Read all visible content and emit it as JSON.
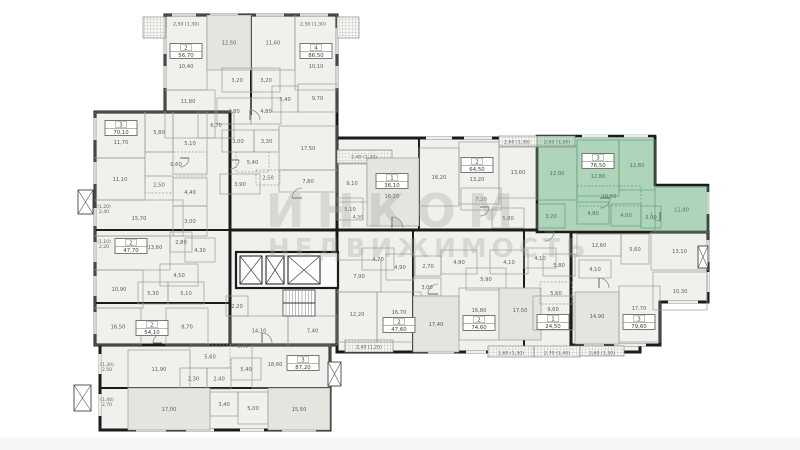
{
  "watermark": {
    "line1": "ИНКОМ",
    "line2": "НЕДВИЖИМОСТЬ"
  },
  "palette": {
    "wall": "#1b1b1b",
    "fill": "#f0f0ec",
    "fill2": "#e5e5df",
    "thin": "#9c9c96",
    "green": "#aed5ba",
    "greenLine": "#67997b",
    "greenText": "#4d7560",
    "text": "#5f5f5a",
    "badgeBorder": "#6b6b66"
  },
  "plan": {
    "sections": [
      {
        "r": [
          165,
          15,
          172,
          215
        ]
      },
      {
        "r": [
          95,
          112,
          135,
          233
        ]
      },
      {
        "r": [
          100,
          345,
          230,
          85
        ]
      },
      {
        "r": [
          230,
          230,
          107,
          115
        ]
      },
      {
        "r": [
          337,
          138,
          318,
          92
        ]
      },
      {
        "r": [
          337,
          230,
          303,
          122
        ]
      },
      {
        "p": "571,232 708,232 708,302 660,302 660,345 571,345"
      }
    ],
    "green_unit": {
      "points": "537,136 655,136 655,185 708,185 708,232 537,232"
    },
    "walls": [
      [
        251,
        15,
        251,
        115
      ],
      [
        419,
        138,
        419,
        230
      ],
      [
        413,
        230,
        413,
        352
      ],
      [
        524,
        230,
        524,
        352
      ],
      [
        571,
        232,
        571,
        345
      ],
      [
        95,
        230,
        230,
        230
      ],
      [
        95,
        303,
        230,
        303
      ],
      [
        100,
        388,
        330,
        388
      ],
      [
        230,
        140,
        230,
        345
      ]
    ],
    "rooms": [
      [
        165,
        15,
        42,
        75,
        "10,40",
        "",
        186,
        66
      ],
      [
        207,
        15,
        44,
        55,
        "12,50",
        "2"
      ],
      [
        251,
        15,
        44,
        55,
        "11,60",
        ""
      ],
      [
        295,
        15,
        42,
        75,
        "10,10",
        "",
        316,
        66
      ],
      [
        222,
        68,
        30,
        24,
        "3,20",
        ""
      ],
      [
        252,
        68,
        28,
        24,
        "3,20",
        ""
      ],
      [
        272,
        86,
        26,
        26,
        "5,40",
        ""
      ],
      [
        298,
        84,
        39,
        28,
        "9,70",
        ""
      ],
      [
        217,
        98,
        34,
        26,
        "4,80",
        ""
      ],
      [
        251,
        98,
        30,
        26,
        "4,80",
        ""
      ],
      [
        198,
        112,
        36,
        26,
        "6,70",
        ""
      ],
      [
        165,
        90,
        50,
        48,
        "11,80",
        "",
        188,
        101
      ],
      [
        222,
        130,
        32,
        22,
        "3,00",
        ""
      ],
      [
        254,
        130,
        25,
        22,
        "3,30",
        ""
      ],
      [
        279,
        126,
        58,
        44,
        "17,50",
        "",
        308,
        148
      ],
      [
        236,
        152,
        33,
        20,
        "5,40",
        "d"
      ],
      [
        256,
        170,
        24,
        15,
        "2,50",
        "d"
      ],
      [
        279,
        170,
        58,
        22,
        "7,80",
        ""
      ],
      [
        220,
        174,
        40,
        20,
        "3,90",
        ""
      ],
      [
        95,
        112,
        50,
        46,
        "11,70",
        "",
        121,
        142
      ],
      [
        145,
        112,
        28,
        40,
        "5,80",
        ""
      ],
      [
        173,
        112,
        34,
        62,
        "5,10",
        ""
      ],
      [
        145,
        152,
        62,
        24,
        "9,60",
        "d"
      ],
      [
        95,
        158,
        50,
        42,
        "11,10",
        ""
      ],
      [
        145,
        176,
        28,
        17,
        "2,50",
        "d"
      ],
      [
        173,
        178,
        34,
        28,
        "4,40",
        ""
      ],
      [
        95,
        200,
        88,
        36,
        "15,70",
        ""
      ],
      [
        173,
        206,
        34,
        30,
        "3,00",
        ""
      ],
      [
        95,
        236,
        75,
        34,
        "13,60",
        "",
        155,
        247
      ],
      [
        170,
        232,
        22,
        20,
        "2,80",
        ""
      ],
      [
        185,
        238,
        30,
        24,
        "4,30",
        ""
      ],
      [
        160,
        264,
        38,
        22,
        "4,50",
        ""
      ],
      [
        95,
        270,
        48,
        38,
        "10,90",
        ""
      ],
      [
        138,
        282,
        30,
        22,
        "5,30",
        ""
      ],
      [
        168,
        282,
        36,
        22,
        "5,10",
        ""
      ],
      [
        95,
        308,
        46,
        37,
        "16,50",
        ""
      ],
      [
        166,
        308,
        42,
        37,
        "8,70",
        ""
      ],
      [
        128,
        350,
        62,
        38,
        "11,90",
        ""
      ],
      [
        190,
        345,
        40,
        23,
        "5,60",
        "d"
      ],
      [
        180,
        368,
        27,
        21,
        "2,30",
        ""
      ],
      [
        207,
        368,
        24,
        21,
        "2,40",
        ""
      ],
      [
        231,
        358,
        30,
        22,
        "5,40",
        ""
      ],
      [
        252,
        345,
        78,
        43,
        "18,60",
        "",
        275,
        364
      ],
      [
        128,
        388,
        82,
        42,
        "17,00",
        "2"
      ],
      [
        210,
        392,
        28,
        24,
        "3,40",
        ""
      ],
      [
        238,
        392,
        30,
        32,
        "5,00",
        ""
      ],
      [
        268,
        388,
        62,
        42,
        "15,50",
        "2"
      ],
      [
        230,
        316,
        58,
        29,
        "14,10",
        ""
      ],
      [
        288,
        316,
        49,
        29,
        "7,40",
        ""
      ],
      [
        226,
        296,
        22,
        20,
        "2,20",
        ""
      ],
      [
        337,
        164,
        30,
        38,
        "9,10",
        ""
      ],
      [
        367,
        158,
        52,
        68,
        "16,20",
        "2",
        392,
        196
      ],
      [
        337,
        198,
        26,
        22,
        "5,10",
        ""
      ],
      [
        419,
        148,
        40,
        58,
        "16,20",
        ""
      ],
      [
        459,
        142,
        40,
        62,
        "13,20",
        "",
        477,
        179
      ],
      [
        499,
        146,
        38,
        52,
        "13,60",
        ""
      ],
      [
        461,
        188,
        40,
        22,
        "7,20",
        ""
      ],
      [
        492,
        208,
        32,
        20,
        "5,80",
        ""
      ],
      [
        537,
        146,
        40,
        54,
        "12,00",
        "g"
      ],
      [
        577,
        140,
        42,
        56,
        "12,80",
        "g",
        598,
        176
      ],
      [
        619,
        140,
        36,
        50,
        "12,80",
        "g"
      ],
      [
        577,
        186,
        64,
        20,
        "10,50",
        "gd"
      ],
      [
        577,
        202,
        32,
        22,
        "4,80",
        "g"
      ],
      [
        611,
        204,
        30,
        22,
        "4,00",
        "g"
      ],
      [
        641,
        206,
        20,
        22,
        "3,00",
        "g"
      ],
      [
        537,
        204,
        28,
        24,
        "3,20",
        "g"
      ],
      [
        655,
        187,
        53,
        45,
        "11,90",
        "g"
      ],
      [
        337,
        260,
        44,
        32,
        "7,90",
        ""
      ],
      [
        362,
        248,
        32,
        22,
        "4,70",
        ""
      ],
      [
        386,
        254,
        28,
        26,
        "4,90",
        ""
      ],
      [
        337,
        292,
        40,
        50,
        "12,20",
        "",
        357,
        314
      ],
      [
        377,
        292,
        44,
        50,
        "16,70",
        "",
        399,
        312
      ],
      [
        413,
        278,
        28,
        18,
        "3,00",
        ""
      ],
      [
        415,
        256,
        26,
        20,
        "2,70",
        ""
      ],
      [
        441,
        250,
        36,
        24,
        "4,80",
        ""
      ],
      [
        490,
        250,
        38,
        24,
        "4,10",
        ""
      ],
      [
        466,
        268,
        40,
        22,
        "5,90",
        ""
      ],
      [
        413,
        296,
        46,
        56,
        "17,40",
        "2"
      ],
      [
        459,
        288,
        40,
        52,
        "16,80",
        "",
        479,
        310
      ],
      [
        499,
        288,
        42,
        52,
        "17,50",
        "2",
        520,
        310
      ],
      [
        524,
        248,
        32,
        20,
        "4,10",
        ""
      ],
      [
        543,
        254,
        32,
        22,
        "5,80",
        ""
      ],
      [
        540,
        282,
        32,
        22,
        "5,60",
        "d"
      ],
      [
        533,
        296,
        40,
        34,
        "9,60",
        "",
        553,
        309
      ],
      [
        577,
        234,
        44,
        22,
        "12,60",
        ""
      ],
      [
        621,
        234,
        28,
        30,
        "5,60",
        ""
      ],
      [
        651,
        232,
        57,
        38,
        "13,10",
        ""
      ],
      [
        579,
        260,
        32,
        18,
        "4,10",
        ""
      ],
      [
        653,
        272,
        54,
        38,
        "10,30",
        ""
      ],
      [
        575,
        292,
        44,
        52,
        "14,90",
        "2",
        597,
        316
      ],
      [
        619,
        286,
        41,
        56,
        "17,70",
        "",
        639,
        308
      ]
    ],
    "labels": [
      [
        186,
        24,
        "2,50 (1,30)"
      ],
      [
        313,
        24,
        "2,50 (1,30)"
      ],
      [
        517,
        142,
        "2,60 (1,30)"
      ],
      [
        557,
        142,
        "2,60 (1,30)",
        "g"
      ],
      [
        364,
        157,
        "2,40 (1,20)"
      ],
      [
        369,
        347,
        "2,40 (1,20)"
      ],
      [
        511,
        353,
        "2,60 (1,30)"
      ],
      [
        557,
        353,
        "2,70 (1,40)"
      ],
      [
        602,
        353,
        "2,60 (1,30)"
      ],
      [
        104,
        208,
        "(1,20)|2,40"
      ],
      [
        104,
        243,
        "(1,10)|2,20"
      ],
      [
        107,
        366,
        "(1,30)|2,50"
      ],
      [
        107,
        401,
        "(1,40)|2,70"
      ],
      [
        358,
        217,
        "4,50"
      ],
      [
        243,
        346,
        "2,60"
      ]
    ],
    "windows": [
      [
        172,
        15,
        196,
        15
      ],
      [
        210,
        15,
        238,
        15
      ],
      [
        256,
        15,
        284,
        15
      ],
      [
        300,
        15,
        328,
        15
      ],
      [
        165,
        28,
        165,
        54
      ],
      [
        165,
        66,
        165,
        88
      ],
      [
        337,
        28,
        337,
        54
      ],
      [
        337,
        66,
        337,
        88
      ],
      [
        95,
        118,
        95,
        140
      ],
      [
        95,
        162,
        95,
        184
      ],
      [
        95,
        208,
        95,
        226
      ],
      [
        95,
        242,
        95,
        262
      ],
      [
        95,
        276,
        95,
        296
      ],
      [
        95,
        312,
        95,
        334
      ],
      [
        100,
        354,
        100,
        374
      ],
      [
        100,
        394,
        100,
        416
      ],
      [
        136,
        430,
        166,
        430
      ],
      [
        186,
        430,
        214,
        430
      ],
      [
        240,
        430,
        264,
        430
      ],
      [
        282,
        430,
        316,
        430
      ],
      [
        426,
        138,
        452,
        138
      ],
      [
        464,
        138,
        492,
        138
      ],
      [
        504,
        138,
        528,
        138
      ],
      [
        582,
        136,
        608,
        136
      ],
      [
        624,
        136,
        648,
        136
      ],
      [
        708,
        192,
        708,
        214
      ],
      [
        708,
        240,
        708,
        262
      ],
      [
        708,
        272,
        708,
        292
      ],
      [
        668,
        302,
        698,
        302
      ],
      [
        584,
        345,
        604,
        345
      ],
      [
        614,
        345,
        646,
        345
      ],
      [
        428,
        352,
        454,
        352
      ],
      [
        466,
        352,
        486,
        352
      ],
      [
        498,
        352,
        516,
        352
      ]
    ],
    "balconies": [
      [
        143,
        17,
        23,
        21,
        ""
      ],
      [
        337,
        17,
        22,
        21,
        ""
      ],
      [
        337,
        150,
        55,
        13,
        ""
      ],
      [
        499,
        136,
        38,
        11,
        ""
      ],
      [
        537,
        136,
        38,
        11,
        "g"
      ],
      [
        345,
        340,
        48,
        12,
        ""
      ],
      [
        488,
        346,
        46,
        11,
        ""
      ],
      [
        534,
        346,
        46,
        11,
        ""
      ],
      [
        580,
        346,
        44,
        10,
        ""
      ]
    ],
    "shaft": [
      236,
      252,
      102,
      36
    ],
    "elevators": [
      [
        240,
        256,
        22,
        28
      ],
      [
        266,
        256,
        18,
        28
      ],
      [
        288,
        256,
        32,
        28
      ]
    ],
    "stairs": {
      "x": 283,
      "y": 290,
      "w": 32,
      "h": 26
    },
    "xboxes": [
      [
        78,
        190,
        15,
        24
      ],
      [
        74,
        385,
        17,
        26
      ],
      [
        328,
        362,
        13,
        24
      ],
      [
        698,
        246,
        10,
        22
      ]
    ],
    "doors": [
      [
        250,
        120,
        10,
        "ne"
      ],
      [
        180,
        158,
        9,
        "se"
      ],
      [
        302,
        198,
        10,
        "nw"
      ],
      [
        392,
        228,
        11,
        "ne"
      ],
      [
        480,
        207,
        9,
        "se"
      ],
      [
        600,
        198,
        10,
        "se"
      ],
      [
        660,
        212,
        9,
        "sw"
      ],
      [
        262,
        343,
        10,
        "ne"
      ],
      [
        438,
        294,
        10,
        "nw"
      ],
      [
        599,
        288,
        10,
        "ne"
      ],
      [
        162,
        343,
        9,
        "nw"
      ],
      [
        545,
        232,
        9,
        "se"
      ],
      [
        230,
        160,
        9,
        "se"
      ]
    ],
    "units": [
      [
        186,
        51,
        "2",
        "56,70",
        0
      ],
      [
        316,
        51,
        "4",
        "86,50",
        0
      ],
      [
        121,
        128,
        "3",
        "70,10",
        0
      ],
      [
        131,
        246,
        "2",
        "47,70",
        0
      ],
      [
        152,
        328,
        "2",
        "54,10",
        0
      ],
      [
        303,
        363,
        "3",
        "87,20",
        0
      ],
      [
        392,
        181,
        "1",
        "36,10",
        0
      ],
      [
        477,
        165,
        "2",
        "64,50",
        0
      ],
      [
        598,
        161,
        "3",
        "76,50",
        1
      ],
      [
        399,
        325,
        "2",
        "47,60",
        0
      ],
      [
        479,
        323,
        "2",
        "74,60",
        0
      ],
      [
        553,
        322,
        "1",
        "24,50",
        0
      ],
      [
        639,
        322,
        "3",
        "79,60",
        0
      ]
    ]
  }
}
